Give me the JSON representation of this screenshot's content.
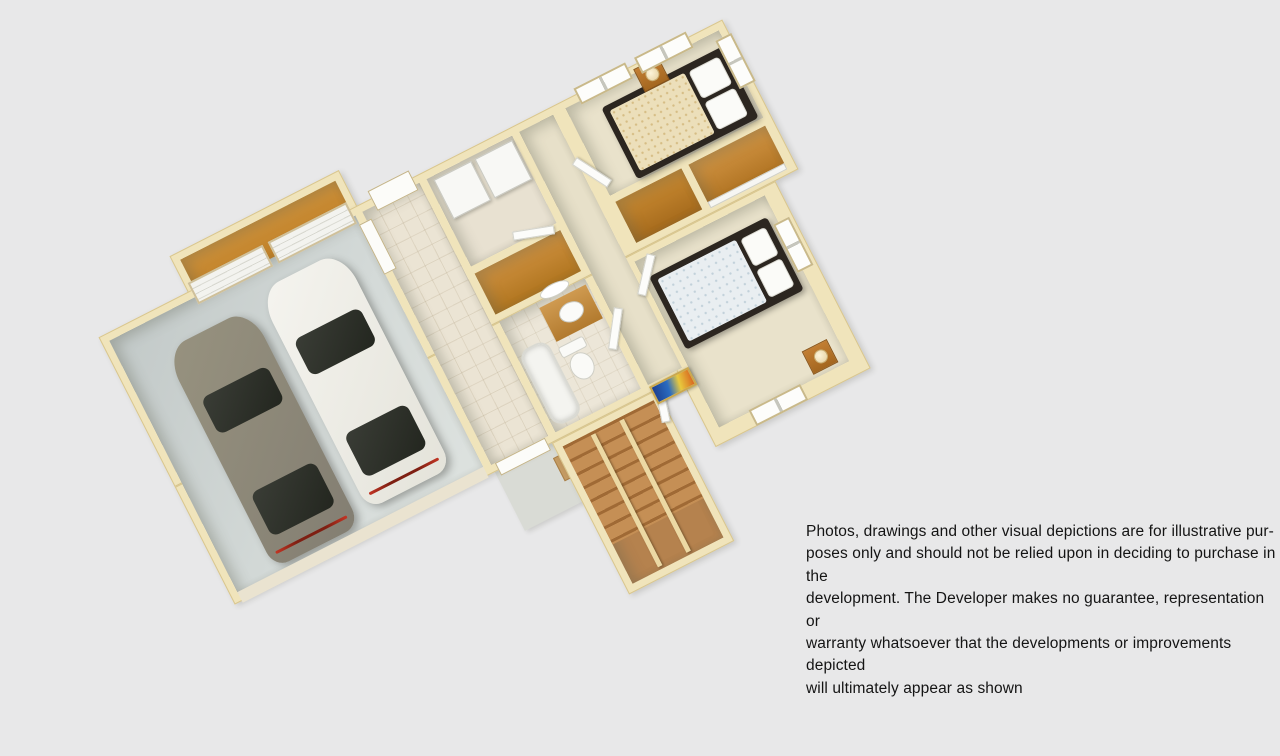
{
  "canvas": {
    "width": 1280,
    "height": 656,
    "background": "#e8e8e9"
  },
  "disclaimer": {
    "lines": [
      "Photos, drawings and other visual depictions are for illustrative pur-",
      "poses only and should not be relied upon in deciding to purchase in the",
      "development.  The Developer makes no guarantee, representation or",
      "warranty whatsoever that the developments or improvements depicted",
      "will ultimately appear as shown"
    ]
  },
  "floor_plan": {
    "view": "3d-cutaway-dollhouse",
    "rotation_deg": -27,
    "rooms": [
      "garage",
      "workbench-bay",
      "entry-hall",
      "laundry",
      "linen-closet",
      "bathroom",
      "hallway",
      "bedroom-1",
      "bedroom-closets",
      "bedroom-2",
      "staircase",
      "front-porch"
    ],
    "objects": [
      "gray-car",
      "white-car",
      "garage-doors",
      "washer",
      "dryer",
      "bathtub",
      "toilet",
      "vanity-with-sink",
      "oval-mirror",
      "bed-with-patterned-duvet",
      "bed-with-white-duvet",
      "nightstand-with-lamp-1",
      "nightstand-with-lamp-2",
      "closet-shelving",
      "sliding-closet-doors",
      "stair-railings",
      "wall-artwork",
      "porch-box"
    ],
    "colors": {
      "background": "#e8e8e9",
      "wall_top": "#f0e4bb",
      "wall_trim": "#d9c68e",
      "interior_wall_shadow": "#b3b7a5",
      "bedroom_carpet": "#e9e2cb",
      "tile_floor": "#ebe4d4",
      "garage_floor": "#cdd4d2",
      "cabinet_wood": "#c0842f",
      "stair_wood": "#b5824e",
      "car_gray": "#8e897d",
      "car_white": "#f0efe9",
      "bed1_duvet": "#ecdfba",
      "bed2_duvet": "#e9eef1",
      "bed_frame": "#2c2620",
      "artwork_blue": "#1c3f8f",
      "artwork_yellow": "#e8c93e"
    }
  }
}
